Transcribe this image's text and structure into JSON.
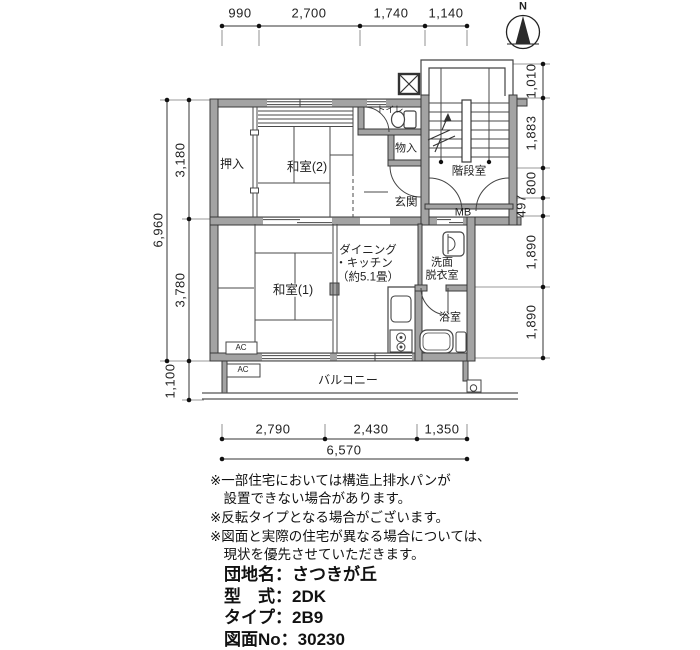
{
  "compass": {
    "north_label": "N"
  },
  "dimensions": {
    "top": [
      "990",
      "2,700",
      "1,740",
      "1,140"
    ],
    "left": {
      "total": "6,960",
      "upper": "3,180",
      "lower": "3,780",
      "balcony": "1,100"
    },
    "right": [
      "1,010",
      "1,883",
      "800",
      "497",
      "1,890",
      "1,890"
    ],
    "bottom": {
      "segments": [
        "2,790",
        "2,430",
        "1,350"
      ],
      "total": "6,570"
    }
  },
  "rooms": {
    "oshiire": "押入",
    "washitsu2": "和室(2)",
    "toilet": "トイレ",
    "monoire": "物入",
    "genkan": "玄関",
    "kaidanshitsu": "階段室",
    "mb": "MB",
    "washitsu1": "和室(1)",
    "dk_line1": "ダイニング",
    "dk_line2": "・キッチン",
    "dk_line3": "（約5.1畳）",
    "senmen_line1": "洗面",
    "senmen_line2": "脱衣室",
    "yokushitsu": "浴室",
    "balcony": "バルコニー",
    "ac": "AC"
  },
  "notes": [
    "※一部住宅においては構造上排水パンが\n設置できない場合があります。",
    "※反転タイプとなる場合がございます。",
    "※図面と実際の住宅が異なる場合については、\n現状を優先させていただきます。"
  ],
  "info": {
    "separator": "：",
    "rows": [
      {
        "label": "団地名",
        "value": "さつきが丘"
      },
      {
        "label": "型　式",
        "value": "2DK"
      },
      {
        "label": "タイプ",
        "value": "2B9"
      },
      {
        "label": "図面No",
        "value": "30230"
      }
    ]
  }
}
